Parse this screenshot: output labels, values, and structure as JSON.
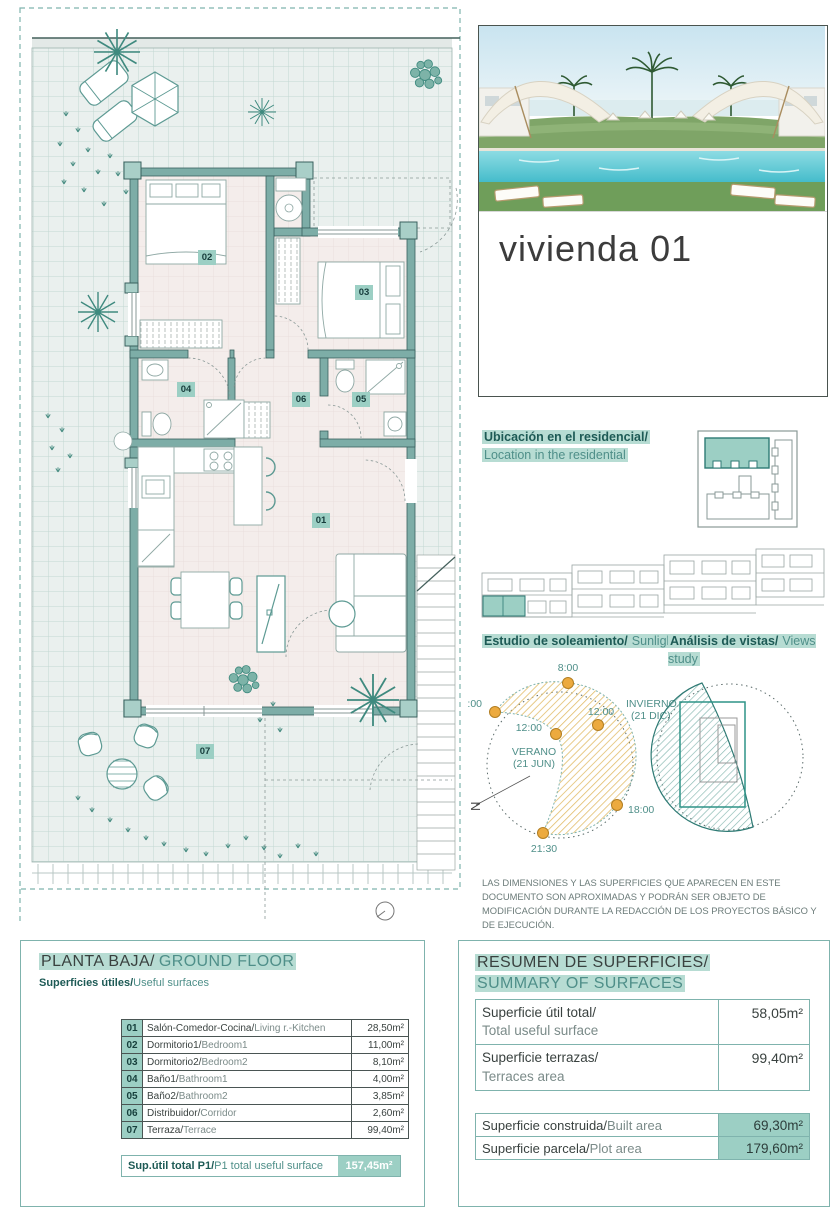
{
  "colors": {
    "wall_teal": "#7dada7",
    "highlight_teal": "#9ccfc4",
    "teal_text": "#4f8f89",
    "dark_teal": "#1d5a55",
    "sun_orange": "#ecaa3f"
  },
  "photo_card": {
    "title": "vivienda 01"
  },
  "location": {
    "label_es": "Ubicación en el residencial/",
    "label_en": "Location in the residential"
  },
  "studies": {
    "sunlight_es": "Estudio de soleamiento/",
    "sunlight_en": "Sunlight study",
    "views_es": "Análisis de vistas/",
    "views_en": "Views study"
  },
  "sun_study": {
    "t_800": "8:00",
    "t_700": "7:00",
    "t_1200_summer": "12:00",
    "t_1200_winter": "12:00",
    "t_1800": "18:00",
    "t_2130": "21:30",
    "winter_line1": "INVIERNO",
    "winter_line2": "(21 DIC)",
    "summer_line1": "VERANO",
    "summer_line2": "(21 JUN)",
    "north": "N"
  },
  "disclaimer": "LAS DIMENSIONES Y LAS SUPERFICIES QUE APARECEN EN ESTE DOCUMENTO SON APROXIMADAS Y PODRÁN SER OBJETO DE MODIFICACIÓN DURANTE LA REDACCIÓN DE LOS PROYECTOS BÁSICO Y DE EJECUCIÓN.",
  "floor_plan": {
    "labels": {
      "r01": "01",
      "r02": "02",
      "r03": "03",
      "r04": "04",
      "r05": "05",
      "r06": "06",
      "r07": "07"
    }
  },
  "ground_floor": {
    "title_es": "PLANTA BAJA/",
    "title_en": "GROUND FLOOR",
    "subtitle_es": "Superficies útiles/",
    "subtitle_en": "Useful surfaces",
    "rooms": [
      {
        "num": "01",
        "name_es": "Salón-Comedor-Cocina/",
        "name_en": "Living r.-Kitchen",
        "area": "28,50m²"
      },
      {
        "num": "02",
        "name_es": "Dormitorio1/",
        "name_en": "Bedroom1",
        "area": "11,00m²"
      },
      {
        "num": "03",
        "name_es": "Dormitorio2/",
        "name_en": "Bedroom2",
        "area": "8,10m²"
      },
      {
        "num": "04",
        "name_es": "Baño1/",
        "name_en": "Bathroom1",
        "area": "4,00m²"
      },
      {
        "num": "05",
        "name_es": "Baño2/",
        "name_en": "Bathroom2",
        "area": "3,85m²"
      },
      {
        "num": "06",
        "name_es": "Distribuidor/",
        "name_en": "Corridor",
        "area": "2,60m²"
      },
      {
        "num": "07",
        "name_es": "Terraza/",
        "name_en": "Terrace",
        "area": "99,40m²"
      }
    ],
    "total": {
      "label_es": "Sup.útil total P1/",
      "label_en": "P1 total useful surface",
      "area": "157,45m²"
    }
  },
  "summary": {
    "title_es": "RESUMEN DE SUPERFICIES/",
    "title_en": "SUMMARY OF SURFACES",
    "rows_top": [
      {
        "label_es": "Superficie útil total/",
        "label_en": "Total useful surface",
        "area": "58,05m²"
      },
      {
        "label_es": "Superficie terrazas/",
        "label_en": "Terraces area",
        "area": "99,40m²"
      }
    ],
    "rows_bottom": [
      {
        "label_es": "Superficie construida/",
        "label_en": "Built area",
        "area": "69,30m²"
      },
      {
        "label_es": "Superficie parcela/",
        "label_en": "Plot area",
        "area": "179,60m²"
      }
    ]
  }
}
